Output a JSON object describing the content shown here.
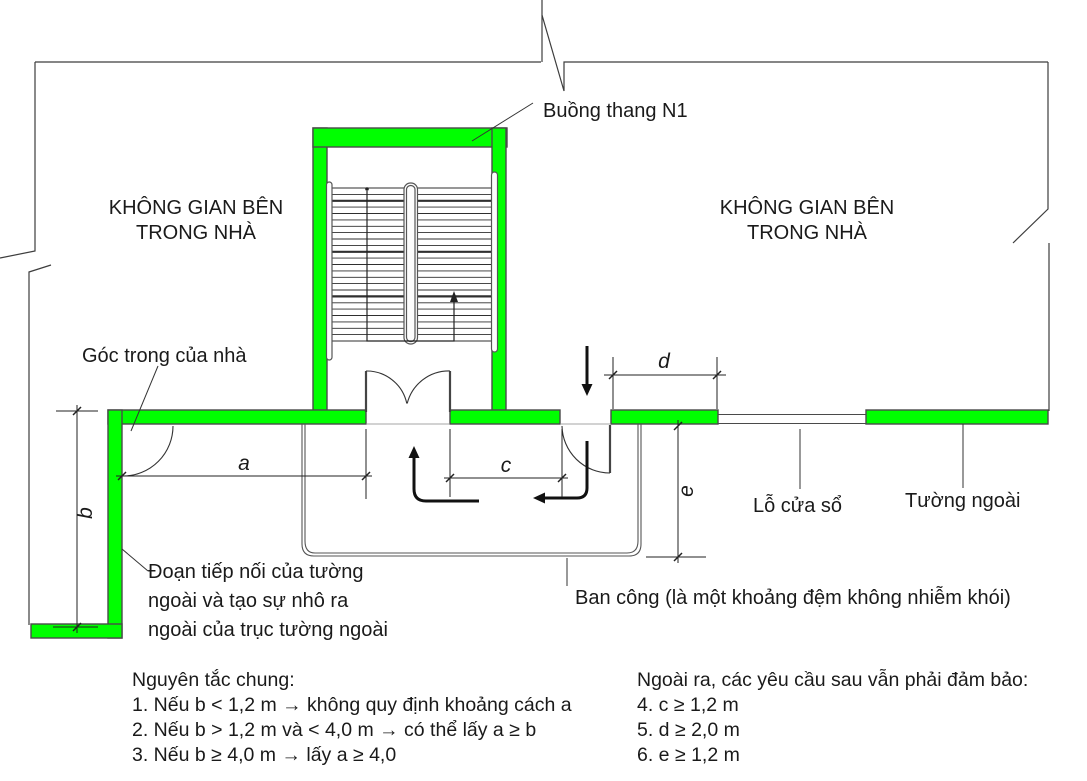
{
  "drawing": {
    "stair_label": "Buồng thang N1",
    "interior_space_left": [
      "KHÔNG GIAN BÊN",
      "TRONG NHÀ"
    ],
    "interior_space_right": [
      "KHÔNG GIAN BÊN",
      "TRONG NHÀ"
    ],
    "inner_corner_label": "Góc trong của nhà",
    "window_label": "Lỗ cửa sổ",
    "outer_wall_label": "Tường ngoài",
    "balcony_label": "Ban công (là một khoảng đệm không nhiễm khói)",
    "wall_extension_label": [
      "Đoạn tiếp nối của tường",
      "ngoài và tạo sự nhô ra",
      "ngoài của trục tường ngoài"
    ],
    "dims": {
      "a": "a",
      "b": "b",
      "c": "c",
      "d": "d",
      "e": "e"
    },
    "colors": {
      "wall": "#00ff00",
      "outline": "#4a4a4a",
      "text": "#1a1a1a"
    }
  },
  "notes_left": {
    "heading": "Nguyên tắc chung:",
    "items": [
      "1. Nếu b < 1,2 m → không quy định khoảng cách a",
      "2. Nếu b > 1,2 m và < 4,0 m →  có thể lấy a ≥ b",
      "3. Nếu b ≥ 4,0 m → lấy a ≥ 4,0"
    ]
  },
  "notes_right": {
    "heading": "Ngoài ra, các yêu cầu sau vẫn phải đảm bảo:",
    "items": [
      "4. c ≥ 1,2 m",
      "5. d ≥  2,0 m",
      "6. e ≥  1,2 m"
    ]
  }
}
